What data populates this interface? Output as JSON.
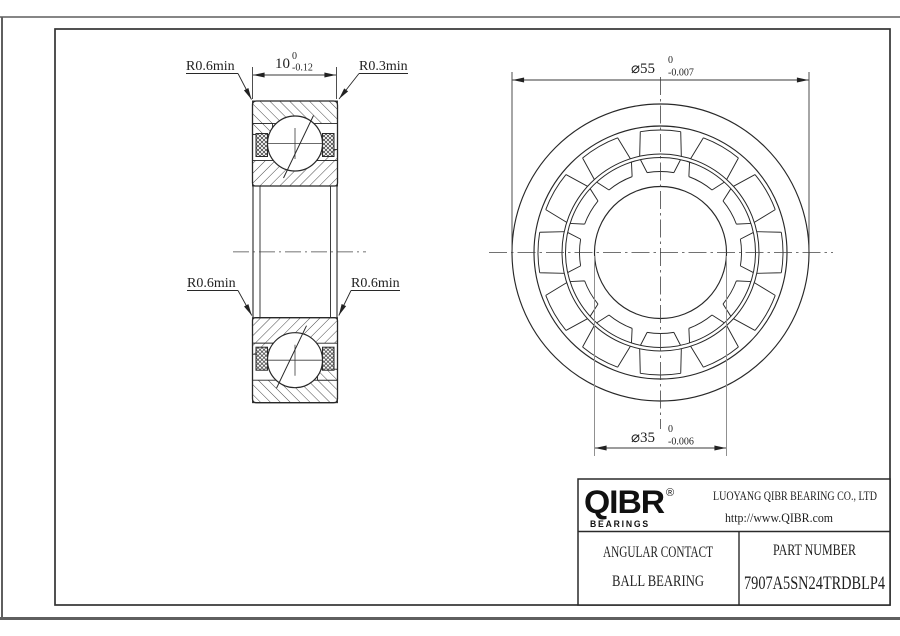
{
  "drawing": {
    "type": "bearing-engineering-drawing",
    "section_labels": {
      "r06_top_left": "R0.6min",
      "r03_top_right": "R0.3min",
      "r06_bottom_left": "R0.6min",
      "r06_bottom_right": "R0.6min"
    },
    "dimensions": {
      "width": {
        "value": "10",
        "tol_upper": "0",
        "tol_lower": "-0.12"
      },
      "outer_diameter": {
        "value": "⌀55",
        "tol_upper": "0",
        "tol_lower": "-0.007"
      },
      "bore_diameter": {
        "value": "⌀35",
        "tol_upper": "0",
        "tol_lower": "-0.006"
      }
    }
  },
  "title_block": {
    "logo_text": "QIBR",
    "logo_reg": "®",
    "logo_sub": "BEARINGS",
    "company": "LUOYANG QIBR BEARING CO., LTD",
    "website": "http://www.QIBR.com",
    "product_line1": "ANGULAR CONTACT",
    "product_line2": "BALL BEARING",
    "part_number_label": "PART NUMBER",
    "part_number": "7907A5SN24TRDBLP4"
  },
  "colors": {
    "object_line": "#282828",
    "dim_line": "#3a3a3a",
    "extension_gray": "#909090",
    "frame": "#333333",
    "page_border": "#5f5f5f",
    "background": "#ffffff"
  }
}
